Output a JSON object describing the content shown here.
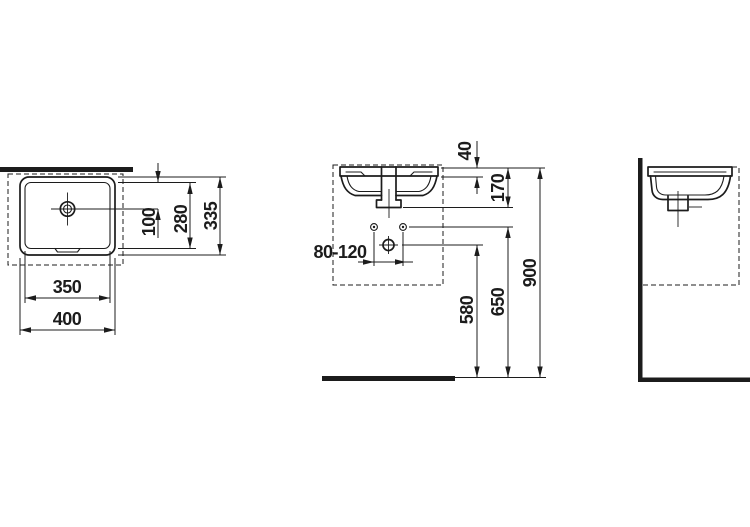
{
  "colors": {
    "line": "#1c1c1c",
    "background": "#ffffff"
  },
  "views": {
    "top": {
      "dims": {
        "drain_offset": "100",
        "inner_depth": "280",
        "outer_depth": "335",
        "inner_width": "350",
        "outer_width": "400"
      }
    },
    "front": {
      "dims": {
        "rim_depth": "40",
        "basin_height": "170",
        "tap_hole_spacing": "80-120",
        "waste_outlet_height": "580",
        "supply_height": "650",
        "top_edge_height": "900"
      }
    }
  }
}
